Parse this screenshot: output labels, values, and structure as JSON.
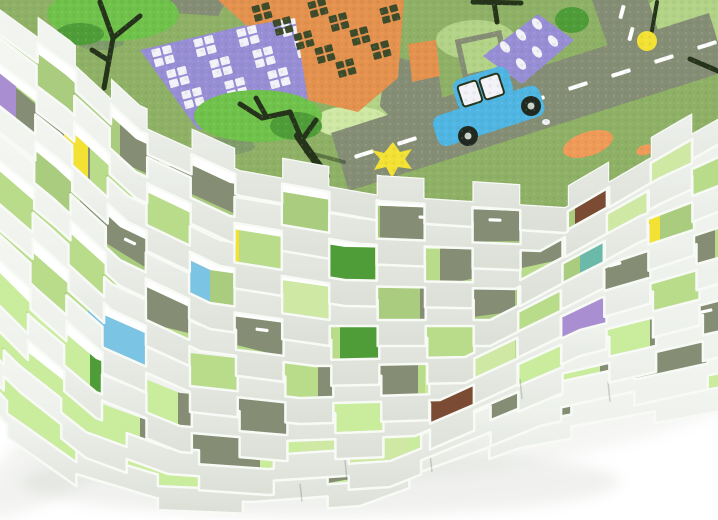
{
  "scene": {
    "subject": "stack-of-foam-puzzle-play-mats",
    "visible_mat_layers": 9,
    "background": "#ffffff"
  },
  "colors": {
    "bg": "#ffffff",
    "foamLight": "#f5f7f3",
    "foamMid": "#eef1ec",
    "foamDark": "#dbdfd6",
    "foamStroke": "#f8faf6",
    "seam": "rgba(62,72,54,0.22)",
    "grass1": "#8fb166",
    "grass2": "#b3d387",
    "grass3": "#cfe8a4",
    "road": "#858e75",
    "roadDash": "#ffffff",
    "stripA": "#a9cc7e",
    "stripB": "#b8dc8a",
    "stripC": "#c9ec9d",
    "purpleBld": "#978ed6",
    "purpleAcc": "#a98fd2",
    "windowWhite": "#f2f2f8",
    "orangeBld": "#e4924e",
    "orangeAcc": "#f09a58",
    "windowDark": "#3d4b2a",
    "treeBright": "#6fc24a",
    "treeMid": "#4f9d38",
    "treeShadow": "#7f9c6a",
    "treeDark": "#243319",
    "carBlue": "#4fb6e3",
    "wheelDark": "#20291f",
    "wheelHub": "#ccd5c9",
    "yellow": "#f3e234",
    "teal": "#6ab9a9",
    "brown": "#7b4b33",
    "blue": "#7cc4e4",
    "shadow": "#8a9480"
  },
  "shadows": [
    [
      320,
      482,
      300,
      34,
      0,
      0.12
    ],
    [
      110,
      420,
      160,
      40,
      -35,
      0.1
    ],
    [
      560,
      430,
      190,
      28,
      -12,
      0.08
    ]
  ],
  "stack": {
    "layers": [
      {
        "name": "top-mat",
        "spine": [
          [
            -40,
            -40
          ],
          [
            70,
            40
          ],
          [
            140,
            105
          ],
          [
            240,
            150
          ],
          [
            380,
            175
          ],
          [
            565,
            187
          ],
          [
            680,
            120
          ],
          [
            760,
            75
          ]
        ],
        "amp": 20,
        "period": 96,
        "phase": 0,
        "strip_h": 10,
        "face_h": 26,
        "base": "stripA",
        "segments": []
      },
      {
        "name": "mat-2",
        "spine": [
          [
            -40,
            8
          ],
          [
            66,
            88
          ],
          [
            136,
            152
          ],
          [
            230,
            196
          ],
          [
            360,
            218
          ],
          [
            540,
            225
          ],
          [
            660,
            158
          ],
          [
            760,
            112
          ]
        ],
        "amp": 20,
        "period": 96,
        "phase": 1,
        "strip_h": 13,
        "face_h": 26,
        "base": "stripA",
        "segments": [
          {
            "x": 120,
            "w": 140,
            "c": "road",
            "dash": [
              165
            ]
          },
          {
            "x": 380,
            "w": 175,
            "c": "road",
            "dash": [
              425,
              495
            ]
          },
          {
            "x": 575,
            "w": 50,
            "c": "brown"
          },
          {
            "x": 640,
            "w": 110,
            "c": "grass3"
          }
        ]
      },
      {
        "name": "mat-3",
        "spine": [
          [
            -40,
            55
          ],
          [
            60,
            134
          ],
          [
            128,
            196
          ],
          [
            220,
            240
          ],
          [
            345,
            260
          ],
          [
            515,
            263
          ],
          [
            640,
            196
          ],
          [
            760,
            150
          ]
        ],
        "amp": 20,
        "period": 96,
        "phase": 0,
        "strip_h": 13,
        "face_h": 26,
        "base": "stripB",
        "segments": [
          {
            "x": -40,
            "w": 130,
            "c": "road"
          },
          {
            "x": -6,
            "w": 22,
            "c": "purpleAcc"
          },
          {
            "x": 64,
            "w": 24,
            "c": "yellow"
          },
          {
            "x": 205,
            "w": 34,
            "c": "yellow"
          },
          {
            "x": 330,
            "w": 45,
            "c": "treeMid"
          },
          {
            "x": 440,
            "w": 130,
            "c": "road",
            "dash": [
              495
            ]
          },
          {
            "x": 600,
            "w": 70,
            "c": "grass3"
          }
        ]
      },
      {
        "name": "mat-4",
        "spine": [
          [
            -40,
            102
          ],
          [
            55,
            180
          ],
          [
            120,
            240
          ],
          [
            210,
            283
          ],
          [
            330,
            300
          ],
          [
            490,
            300
          ],
          [
            620,
            234
          ],
          [
            760,
            188
          ]
        ],
        "amp": 20,
        "period": 96,
        "phase": 1,
        "strip_h": 13,
        "face_h": 26,
        "base": "stripA",
        "segments": [
          {
            "x": 80,
            "w": 130,
            "c": "road",
            "dash": [
              130
            ]
          },
          {
            "x": 165,
            "w": 45,
            "c": "blue"
          },
          {
            "x": 250,
            "w": 110,
            "c": "grass3"
          },
          {
            "x": 420,
            "w": 95,
            "c": "road"
          },
          {
            "x": 580,
            "w": 45,
            "c": "teal"
          },
          {
            "x": 625,
            "w": 35,
            "c": "yellow"
          }
        ]
      },
      {
        "name": "mat-5",
        "spine": [
          [
            -40,
            150
          ],
          [
            48,
            226
          ],
          [
            112,
            284
          ],
          [
            200,
            325
          ],
          [
            315,
            340
          ],
          [
            465,
            337
          ],
          [
            600,
            272
          ],
          [
            760,
            226
          ]
        ],
        "amp": 20,
        "period": 96,
        "phase": 0,
        "strip_h": 13,
        "face_h": 26,
        "base": "stripB",
        "segments": [
          {
            "x": 140,
            "w": 170,
            "c": "road",
            "dash": [
              200,
              262
            ]
          },
          {
            "x": 340,
            "w": 50,
            "c": "treeMid"
          },
          {
            "x": 575,
            "w": 80,
            "c": "road",
            "dash": [
              615
            ]
          },
          {
            "x": 655,
            "w": 60,
            "c": "road",
            "dash": [
              680
            ]
          }
        ]
      },
      {
        "name": "mat-6",
        "spine": [
          [
            -40,
            198
          ],
          [
            40,
            272
          ],
          [
            104,
            328
          ],
          [
            190,
            366
          ],
          [
            300,
            378
          ],
          [
            440,
            374
          ],
          [
            580,
            310
          ],
          [
            760,
            264
          ]
        ],
        "amp": 20,
        "period": 96,
        "phase": 1,
        "strip_h": 13,
        "face_h": 26,
        "base": "stripB",
        "segments": [
          {
            "x": 88,
            "w": 80,
            "c": "blue"
          },
          {
            "x": 318,
            "w": 100,
            "c": "road"
          },
          {
            "x": 425,
            "w": 90,
            "c": "grass3"
          },
          {
            "x": 556,
            "w": 95,
            "c": "purpleAcc"
          }
        ]
      },
      {
        "name": "mat-7",
        "spine": [
          [
            -40,
            246
          ],
          [
            32,
            318
          ],
          [
            96,
            372
          ],
          [
            180,
            406
          ],
          [
            285,
            415
          ],
          [
            415,
            410
          ],
          [
            560,
            348
          ],
          [
            760,
            302
          ]
        ],
        "amp": 20,
        "period": 96,
        "phase": 0,
        "strip_h": 13,
        "face_h": 26,
        "base": "stripC",
        "segments": [
          {
            "x": 90,
            "w": 45,
            "c": "treeMid"
          },
          {
            "x": 178,
            "w": 140,
            "c": "road",
            "dash": [
              228
            ]
          },
          {
            "x": 398,
            "w": 95,
            "c": "brown"
          },
          {
            "x": 650,
            "w": 70,
            "c": "road",
            "dash": [
              682,
              706
            ]
          }
        ],
        "seams": [
          520
        ]
      },
      {
        "name": "mat-8",
        "spine": [
          [
            -50,
            298
          ],
          [
            20,
            366
          ],
          [
            86,
            418
          ],
          [
            168,
            448
          ],
          [
            268,
            455
          ],
          [
            390,
            447
          ],
          [
            540,
            386
          ],
          [
            770,
            336
          ]
        ],
        "amp": 14,
        "period": 150,
        "phase": 1,
        "strip_h": 20,
        "face_h": 26,
        "base": "stripC",
        "segments": [
          {
            "x": 140,
            "w": 120,
            "c": "road"
          },
          {
            "x": 300,
            "w": 110,
            "c": "grass3"
          },
          {
            "x": 430,
            "w": 90,
            "c": "road",
            "dash": [
              472
            ]
          },
          {
            "x": 600,
            "w": 115,
            "c": "road",
            "dash": [
              650
            ]
          }
        ],
        "seams": [
          345,
          608
        ]
      },
      {
        "name": "mat-9",
        "spine": [
          [
            -50,
            338
          ],
          [
            8,
            402
          ],
          [
            76,
            450
          ],
          [
            156,
            474
          ],
          [
            252,
            478
          ],
          [
            360,
            470
          ],
          [
            520,
            412
          ],
          [
            770,
            366
          ]
        ],
        "amp": 12,
        "period": 170,
        "phase": 0,
        "strip_h": 22,
        "face_h": 24,
        "base": "stripC",
        "segments": [
          {
            "x": 280,
            "w": 130,
            "c": "road"
          },
          {
            "x": 500,
            "w": 85,
            "c": "road"
          }
        ],
        "seams": [
          300,
          430
        ]
      }
    ]
  },
  "design": {
    "grass_patches": [
      [
        395,
        100,
        34,
        20,
        "grass2"
      ],
      [
        688,
        26,
        52,
        34,
        "grass2"
      ],
      [
        352,
        122,
        38,
        16,
        "grass3"
      ],
      [
        476,
        40,
        40,
        20,
        "grass2"
      ]
    ],
    "roads": {
      "main": "331,133 709,13 727,71 349,191",
      "branch": "592,0 648,0 662,42 612,58",
      "stub": "163,0 227,0 218,16 158,12",
      "driveway": "390,60 434,70 442,125 420,140 384,105"
    },
    "parking": [
      [
        458,
        42,
        42,
        36,
        -12
      ],
      [
        390,
        112,
        36,
        32,
        -15
      ]
    ],
    "dash_angle_main": -17.6,
    "dash_angle_branch": 15,
    "dashes_main": [
      [
        364,
        154
      ],
      [
        407,
        141
      ],
      [
        450,
        127
      ],
      [
        492,
        114
      ],
      [
        535,
        100
      ],
      [
        578,
        86
      ],
      [
        621,
        73
      ],
      [
        664,
        59
      ],
      [
        707,
        45
      ]
    ],
    "dashes_branch": [
      [
        622,
        12
      ],
      [
        631,
        34
      ]
    ],
    "orange_paths": [
      [
        588,
        144,
        26,
        12,
        -18
      ],
      [
        645,
        150,
        9,
        5,
        -18
      ]
    ],
    "buildings": {
      "purpleA": {
        "points": "140,50 293,14 350,92 198,130",
        "window_tilt": -15,
        "windows": [
          [
            163,
            56
          ],
          [
            205,
            46
          ],
          [
            248,
            36
          ],
          [
            291,
            26
          ],
          [
            178,
            77
          ],
          [
            221,
            67
          ],
          [
            264,
            57
          ],
          [
            306,
            47
          ],
          [
            193,
            98
          ],
          [
            236,
            88
          ],
          [
            279,
            78
          ],
          [
            322,
            68
          ]
        ]
      },
      "orange": {
        "points": "218,0 404,0 398,78 358,112 308,100 295,18 247,26",
        "annex": "408,44 436,40 440,76 412,82",
        "window_tilt": -15,
        "windows": [
          [
            262,
            12
          ],
          [
            283,
            26
          ],
          [
            304,
            40
          ],
          [
            325,
            54
          ],
          [
            346,
            68
          ],
          [
            318,
            8
          ],
          [
            339,
            22
          ],
          [
            360,
            36
          ],
          [
            381,
            50
          ],
          [
            390,
            14
          ]
        ]
      },
      "purpleB": {
        "points": "483,56 538,14 574,40 522,84",
        "oval_tilt": -38,
        "ovals": [
          [
            505,
            47
          ],
          [
            521,
            35
          ],
          [
            537,
            24
          ],
          [
            521,
            64
          ],
          [
            537,
            52
          ],
          [
            553,
            41
          ]
        ]
      }
    },
    "trees": {
      "shadows": [
        [
          225,
          146,
          30,
          9
        ],
        [
          100,
          42,
          24,
          8
        ]
      ],
      "canopies": [
        [
          113,
          14,
          66,
          27,
          "treeBright"
        ],
        [
          80,
          34,
          24,
          11,
          "treeMid"
        ],
        [
          258,
          116,
          64,
          26,
          "treeBright"
        ],
        [
          296,
          126,
          26,
          14,
          "treeMid"
        ],
        [
          572,
          20,
          17,
          13,
          "treeMid"
        ]
      ],
      "branches": [
        "M100,2 L113,38",
        "M113,38 L104,88",
        "M113,38 L140,16",
        "M108,60 L92,50",
        "M240,104 L262,118",
        "M262,118 L290,112",
        "M290,112 L302,140",
        "M266,116 L256,98",
        "M302,140 L316,120"
      ],
      "trunks": [
        "M298,136 L326,176"
      ],
      "streaks": [
        "M306,152 L344,162"
      ]
    },
    "bush": "393,142 400,152 412,149 405,159 412,169 398,167 392,178 386,167 374,170 380,159 372,150 384,153",
    "car": {
      "rot": -18,
      "cx": 489,
      "cy": 120,
      "body": [
        434,
        100,
        112,
        32
      ],
      "cabin": [
        464,
        72,
        58,
        32
      ],
      "windows": [
        [
          469,
          78,
          20,
          22
        ],
        [
          492,
          78,
          20,
          22
        ]
      ],
      "wheels": [
        [
          468,
          136
        ],
        [
          531,
          106
        ]
      ],
      "wheel_r": 10,
      "hub_r": 3.5,
      "headlight": [
        546,
        122
      ]
    },
    "lamps": {
      "pole": "M651,36 L657,2",
      "dot": [
        647,
        41,
        10
      ],
      "arm": "M690,59 L718,71",
      "tpole": "M497,22 L494,2",
      "tbar": "M473,2 L521,3"
    }
  }
}
